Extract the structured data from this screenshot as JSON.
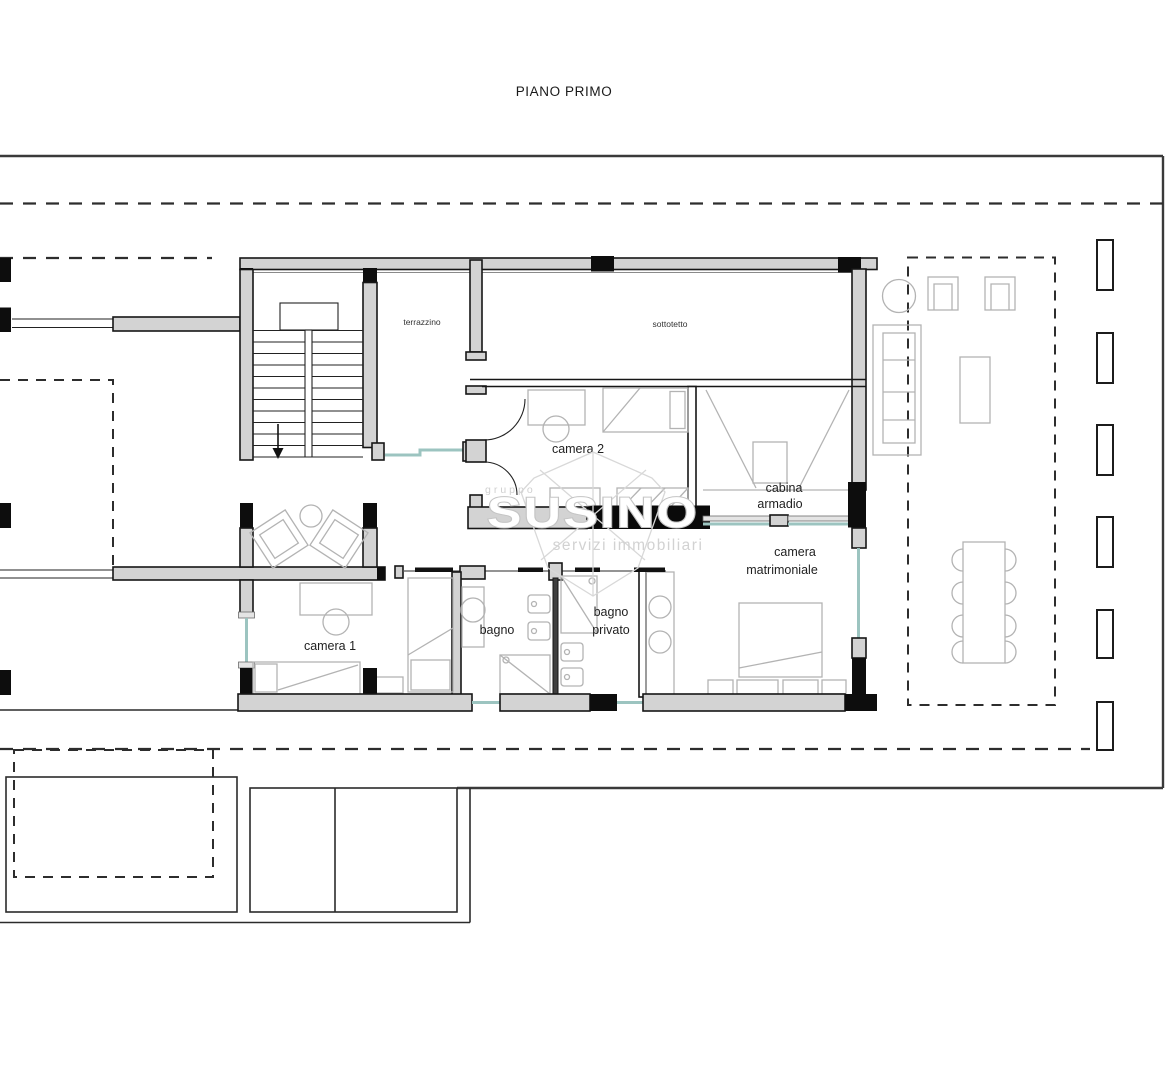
{
  "title": "PIANO PRIMO",
  "floor_plan": {
    "room_labels": {
      "terrazzino": "terrazzino",
      "sottotetto": "sottotetto",
      "camera_2": "camera 2",
      "cabina_armadio_line_1": "cabina",
      "cabina_armadio_line_2": "armadio",
      "camera_matrimoniale_line_1": "camera",
      "camera_matrimoniale_line_2": "matrimoniale",
      "camera_1": "camera 1",
      "bagno": "bagno",
      "bagno_privato_line_1": "bagno",
      "bagno_privato_line_2": "privato"
    },
    "colors": {
      "wall_fill": "#d3d3d3",
      "wall_outline": "#161616",
      "pillar_black": "#0d0d0d",
      "glass_teal": "#9cc4c0",
      "furniture_gray": "#b3b3b3",
      "dashed_line": "#2d2d2d",
      "border": "#3a3a3a"
    }
  },
  "watermark": {
    "line_top": "gruppo",
    "brand": "SUSINO",
    "tagline": "servizi immobiliari",
    "color": "#cccccc"
  }
}
